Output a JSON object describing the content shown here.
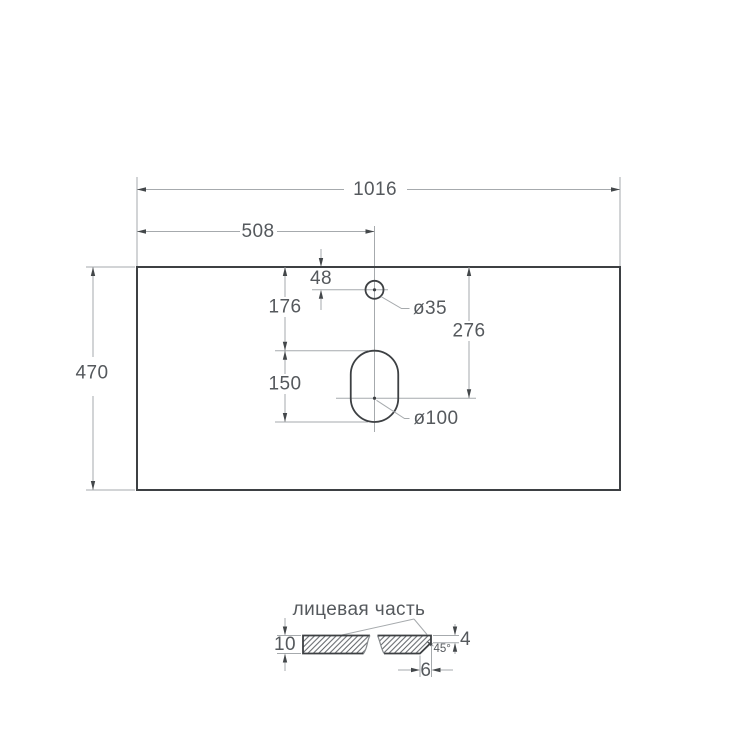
{
  "colors": {
    "background": "#ffffff",
    "outline": "#3d4043",
    "dim_line": "#a6aaad",
    "arrow": "#43474a",
    "text": "#55595d",
    "hatch": "#5e6266",
    "break_line": "#85898c"
  },
  "plan_view": {
    "overall_width": "1016",
    "faucet_center_offset": "508",
    "overall_depth": "470",
    "faucet_hole_edge_offset": "48",
    "slot_top_offset": "176",
    "slot_length": "150",
    "drain_center_offset": "276",
    "faucet_hole_diameter": "ø35",
    "drain_hole_diameter": "ø100"
  },
  "section_view": {
    "face_side_label": "лицевая часть",
    "slab_thickness": "10",
    "front_edge_height": "4",
    "chamfer_angle": "45°",
    "chamfer_width": "6"
  }
}
